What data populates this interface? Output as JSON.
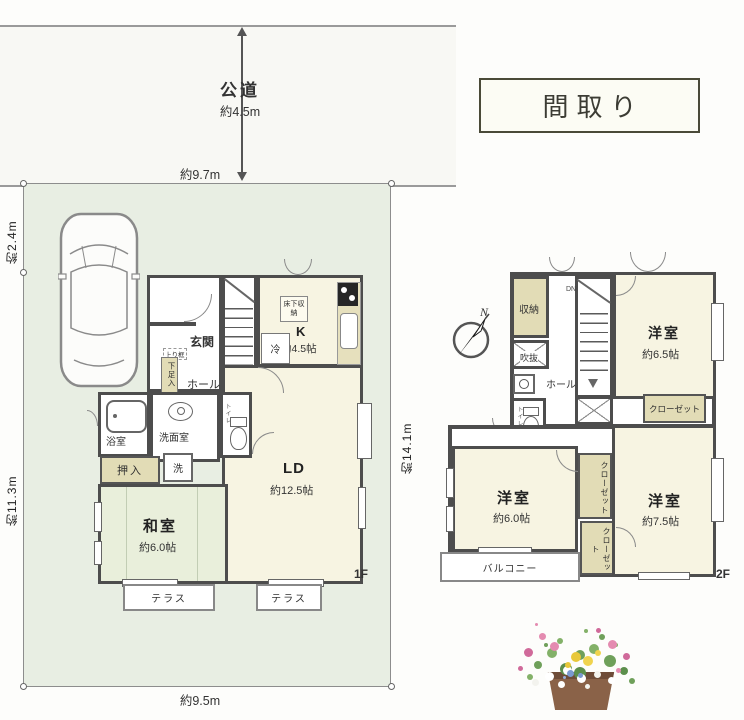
{
  "title_box": {
    "label": "間取り"
  },
  "road": {
    "name": "公道",
    "width": "約4.5m"
  },
  "dimensions": {
    "frontage": "約9.7m",
    "site_left_upper": "約2.4m",
    "site_left_lower": "約11.3m",
    "site_right": "約14.1m",
    "site_bottom": "約9.5m"
  },
  "floor1": {
    "label": "1F",
    "entrance": "玄関",
    "agarikamachi": "上り框",
    "shoe_cabinet": "下足入",
    "hall": "ホール",
    "kitchen_name": "K",
    "kitchen_size": "約4.5帖",
    "underfloor_storage": "床下収納",
    "fridge": "冷",
    "toilet": "トイレ",
    "bath": "浴室",
    "washroom": "洗面室",
    "washer": "洗",
    "oshiire": "押入",
    "ld_name": "LD",
    "ld_size": "約12.5帖",
    "washitsu_name": "和室",
    "washitsu_size": "約6.0帖",
    "terrace1": "テラス",
    "terrace2": "テラス"
  },
  "floor2": {
    "label": "2F",
    "compass_north": "N",
    "storage": "収納",
    "void": "吹抜",
    "hall": "ホール",
    "stairs_down": "DN",
    "toilet": "トイレ",
    "bedroom1_name": "洋室",
    "bedroom1_size": "約6.5帖",
    "closet1": "クローゼット",
    "bedroom2_name": "洋室",
    "bedroom2_size": "約6.0帖",
    "closet2": "クローゼット",
    "closet3": "クローゼット",
    "bedroom3_name": "洋室",
    "bedroom3_size": "約7.5帖",
    "balcony": "バルコニー"
  },
  "colors": {
    "wall": "#4d4d4d",
    "room_cream": "#f7f4e2",
    "tatami_green": "#e9efdb",
    "closet_beige": "#e2dcb6",
    "site_green": "#e8eee3"
  }
}
